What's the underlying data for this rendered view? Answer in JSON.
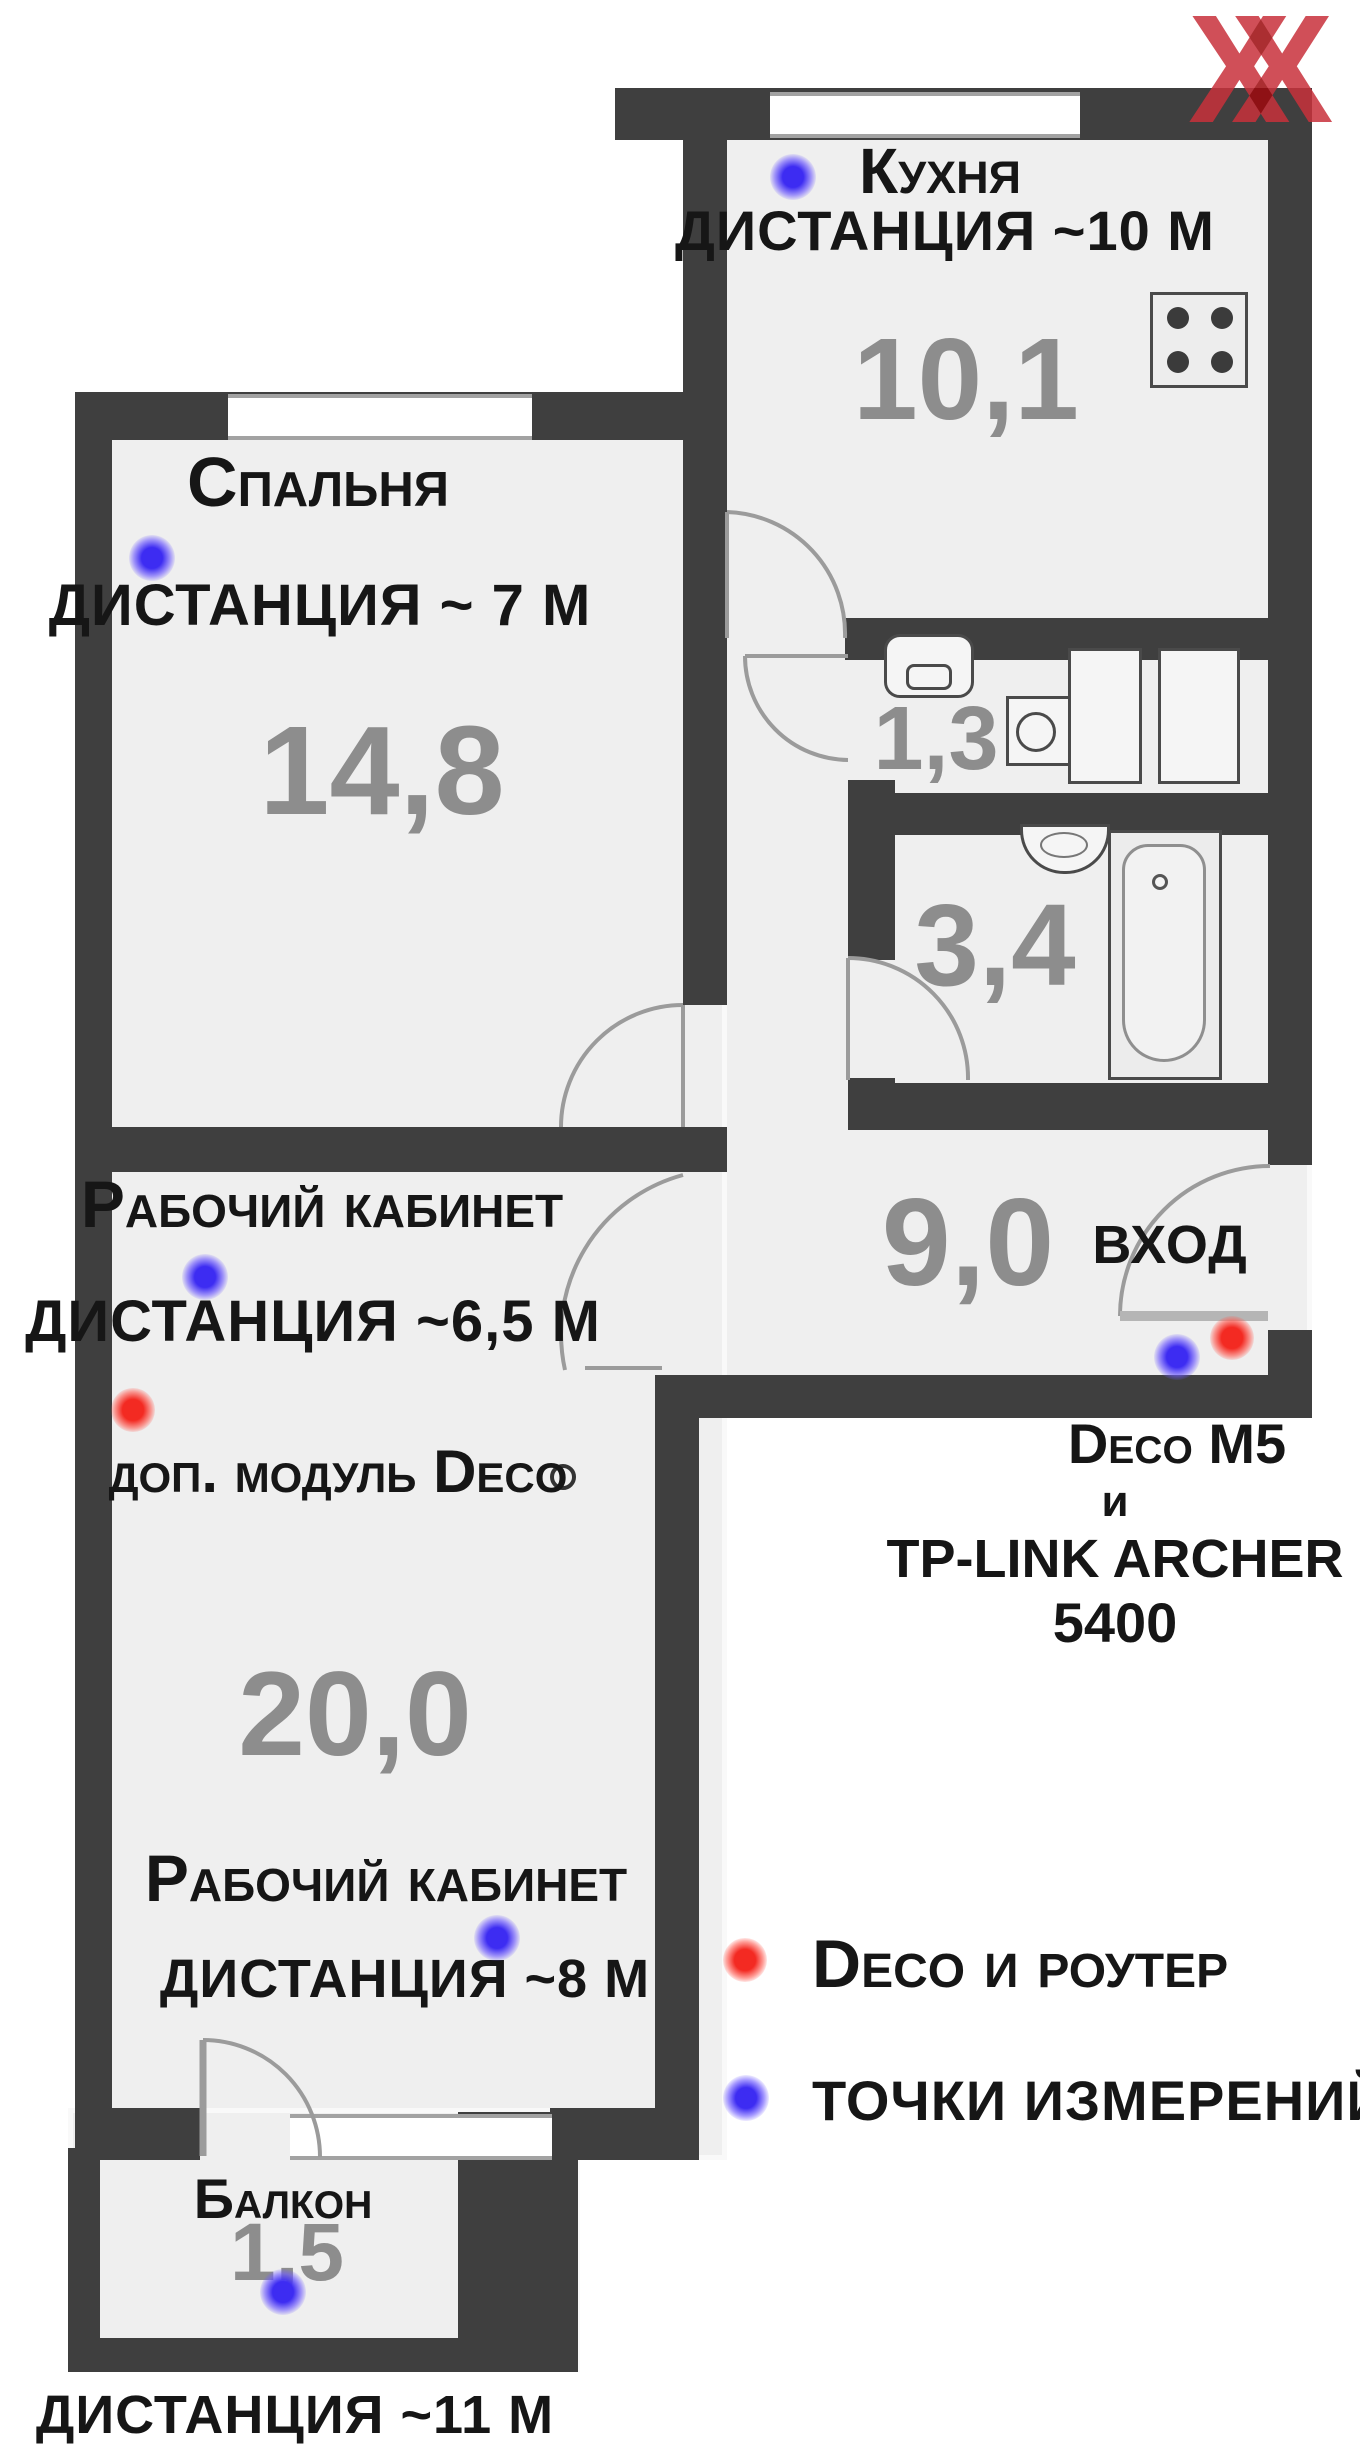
{
  "watermark": {
    "x1": "X",
    "x2": "X"
  },
  "rooms": {
    "kitchen": {
      "name": "Кухня",
      "distance": "дистанция ~10 м",
      "area": "10,1"
    },
    "bedroom": {
      "name": "Спальня",
      "distance": "дистанция ~ 7 м",
      "area": "14,8"
    },
    "wc": {
      "area": "1,3"
    },
    "bath": {
      "area": "3,4"
    },
    "hall": {
      "area": "9,0",
      "entrance": "вход"
    },
    "office": {
      "title_upper": "Рабочий кабинет",
      "distance_upper": "дистанция ~6,5 м",
      "deco_note": "доп. модуль Deco",
      "area": "20,0",
      "title_lower": "Рабочий кабинет",
      "distance_lower": "дистанция  ~8 м"
    },
    "balcony": {
      "name": "Балкон",
      "area": "1,5",
      "distance": "дистанция ~11 м"
    }
  },
  "router_note": {
    "line1": "Deco M5",
    "line2": "и",
    "line3": "TP-LINK ARCHER",
    "line4": "5400"
  },
  "legend": {
    "router_label": "Deco и роутер",
    "points_label": "точки измерений"
  },
  "colors": {
    "wall": "#3f3f3f",
    "floor": "#efefef",
    "area_text": "#8d8d8d",
    "router_dot": "#f32a22",
    "measure_dot": "#3d2cf2",
    "watermark": "#c8313b"
  }
}
